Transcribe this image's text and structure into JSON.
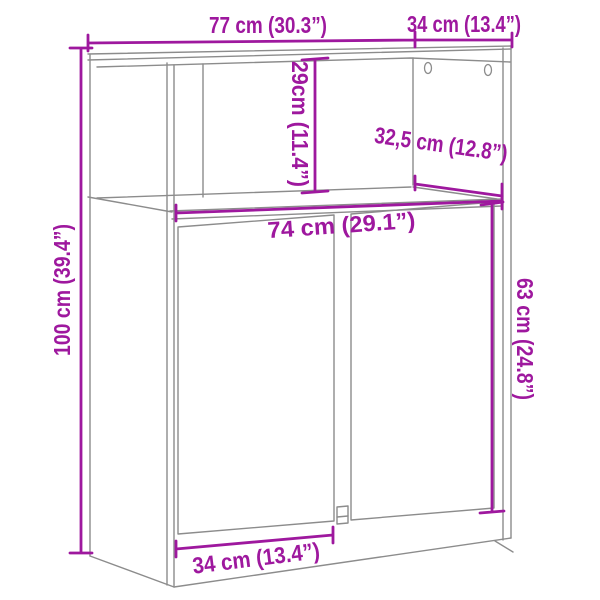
{
  "diagram": {
    "type": "furniture-dimension-drawing",
    "colors": {
      "dimension_accent": "#9E189E",
      "outline_gray": "#8C8C8C",
      "background": "#FFFFFF"
    },
    "dimensions": {
      "width_top": "77 cm (30.3”)",
      "depth_top": "34 cm (13.4”)",
      "open_shelf_height": "29cm (11.4”)",
      "inner_depth": "32,5 cm (12.8”)",
      "inner_width": "74 cm (29.1”)",
      "total_height": "100 cm (39.4”)",
      "door_height": "63 cm (24.8”)",
      "door_width": "34 cm (13.4”)"
    },
    "features": {
      "mounting_holes": 2,
      "doors": 2
    }
  }
}
